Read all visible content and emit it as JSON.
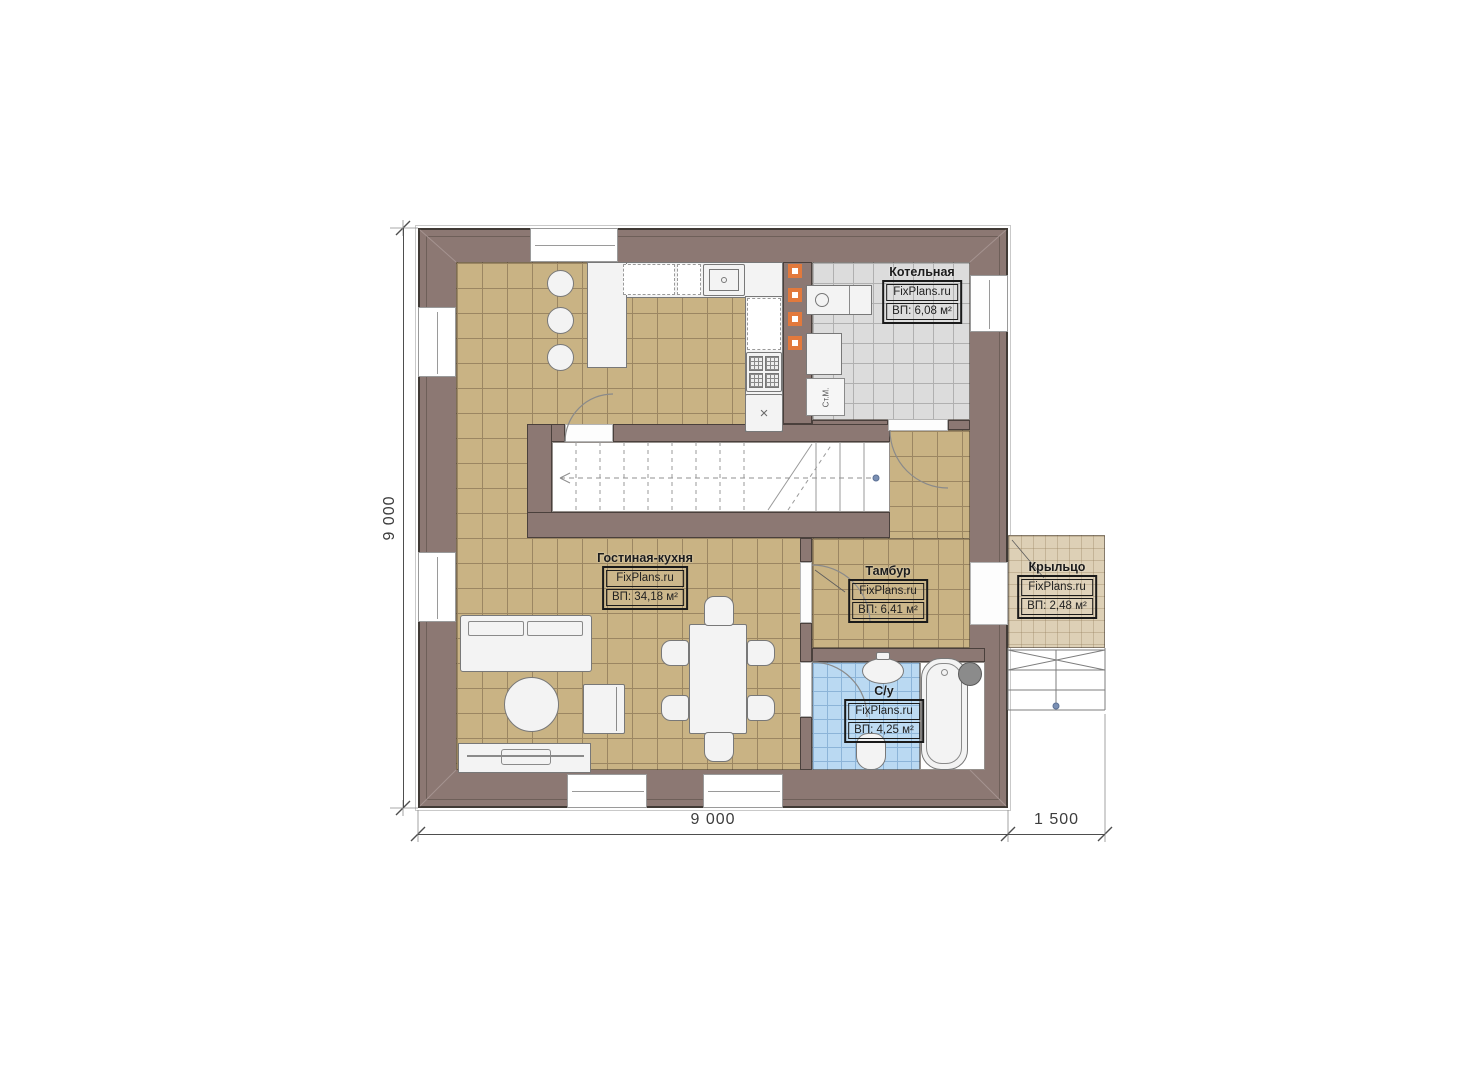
{
  "plan": {
    "rooms": [
      {
        "id": "living",
        "name": "Гостиная-кухня",
        "brand": "FixPlans.ru",
        "area": "ВП: 34,18 м²"
      },
      {
        "id": "boiler",
        "name": "Котельная",
        "brand": "FixPlans.ru",
        "area": "ВП: 6,08 м²"
      },
      {
        "id": "vestibule",
        "name": "Тамбур",
        "brand": "FixPlans.ru",
        "area": "ВП: 6,41 м²"
      },
      {
        "id": "bathroom",
        "name": "С/у",
        "brand": "FixPlans.ru",
        "area": "ВП: 4,25 м²"
      },
      {
        "id": "porch",
        "name": "Крыльцо",
        "brand": "FixPlans.ru",
        "area": "ВП: 2,48 м²"
      }
    ],
    "dimensions": {
      "height_total": "9 000",
      "width_main": "9 000",
      "width_porch": "1 500"
    },
    "annotations": {
      "washing_machine": "Ст.М.",
      "cabinet_mark": "×"
    },
    "colors": {
      "wall_fill": "#8c7873",
      "wall_outline": "#403a35",
      "floor_living": "#c9b384",
      "floor_boiler": "#dcdcdc",
      "floor_bathroom": "#bad9f2",
      "floor_porch": "#ddd0b6",
      "accent_orange": "#e2793c"
    }
  }
}
